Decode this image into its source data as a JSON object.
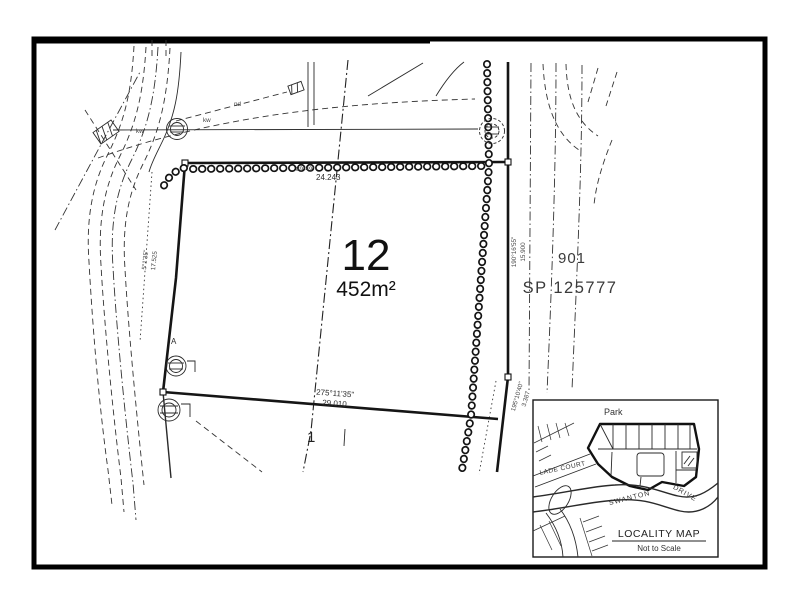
{
  "plan": {
    "lot": {
      "number": "12",
      "area": "452m²"
    },
    "neighbors": {
      "lot_below": "1",
      "lot_right": "901",
      "plan_right": "SP 125777"
    },
    "dimensions": {
      "north": {
        "bearing": "89°49'",
        "distance": "24.243"
      },
      "west": {
        "bearing": "5°1'35\"",
        "distance": "17.525"
      },
      "east": {
        "bearing": "190°16'55\"",
        "distance": "15.900"
      },
      "south": {
        "bearing": "275°11'35\"",
        "distance": "29.010"
      },
      "south_east": {
        "bearing": "195°10'40\"",
        "distance": "3.387"
      }
    },
    "annotations": {
      "kw_1": "kw",
      "kw_2": "kw",
      "nd": "nd",
      "marker": "A"
    }
  },
  "inset": {
    "park": "Park",
    "streets": {
      "swanton": "SWANTON",
      "drive": "DRIVE",
      "court": "LADE COURT"
    },
    "title": "LOCALITY MAP",
    "scale_note": "Not to Scale"
  }
}
